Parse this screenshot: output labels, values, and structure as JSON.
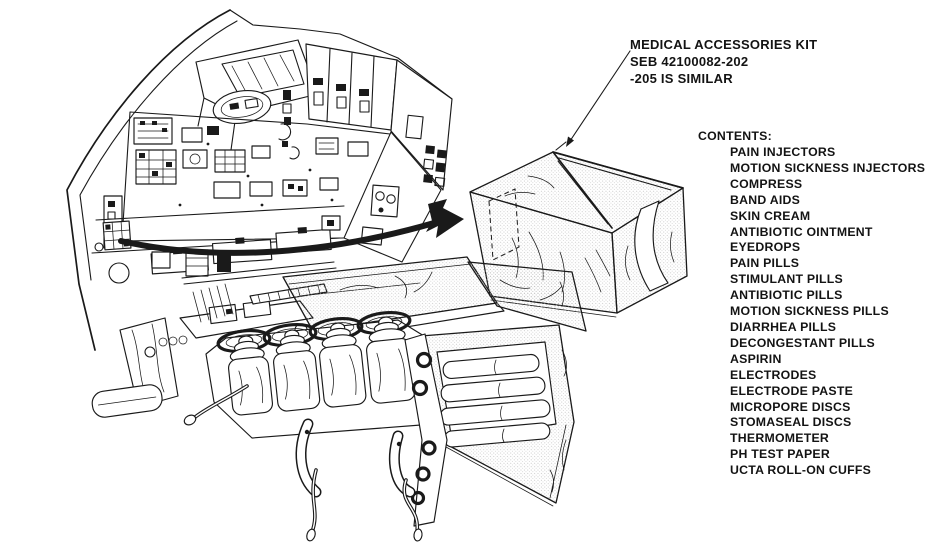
{
  "ink_color": "#1a1a1a",
  "paper_color": "#ffffff",
  "kit_label": {
    "line1": "MEDICAL ACCESSORIES KIT",
    "line2": "SEB 42100082-202",
    "line3": "-205 IS SIMILAR"
  },
  "contents": {
    "header": "CONTENTS:",
    "items": [
      "PAIN INJECTORS",
      "MOTION SICKNESS INJECTORS",
      "COMPRESS",
      "BAND AIDS",
      "SKIN CREAM",
      "ANTIBIOTIC OINTMENT",
      "EYEDROPS",
      "PAIN PILLS",
      "STIMULANT PILLS",
      "ANTIBIOTIC PILLS",
      "MOTION SICKNESS PILLS",
      "DIARRHEA PILLS",
      "DECONGESTANT PILLS",
      "ASPIRIN",
      "ELECTRODES",
      "ELECTRODE PASTE",
      "MICROPORE DISCS",
      "STOMASEAL DISCS",
      "THERMOMETER",
      "PH TEST PAPER",
      "UCTA ROLL-ON CUFFS"
    ]
  },
  "icons": {
    "transfer_arrow": "thick-curved-black-arrow",
    "leader_arrow": "thin-leader-line-arrow"
  }
}
